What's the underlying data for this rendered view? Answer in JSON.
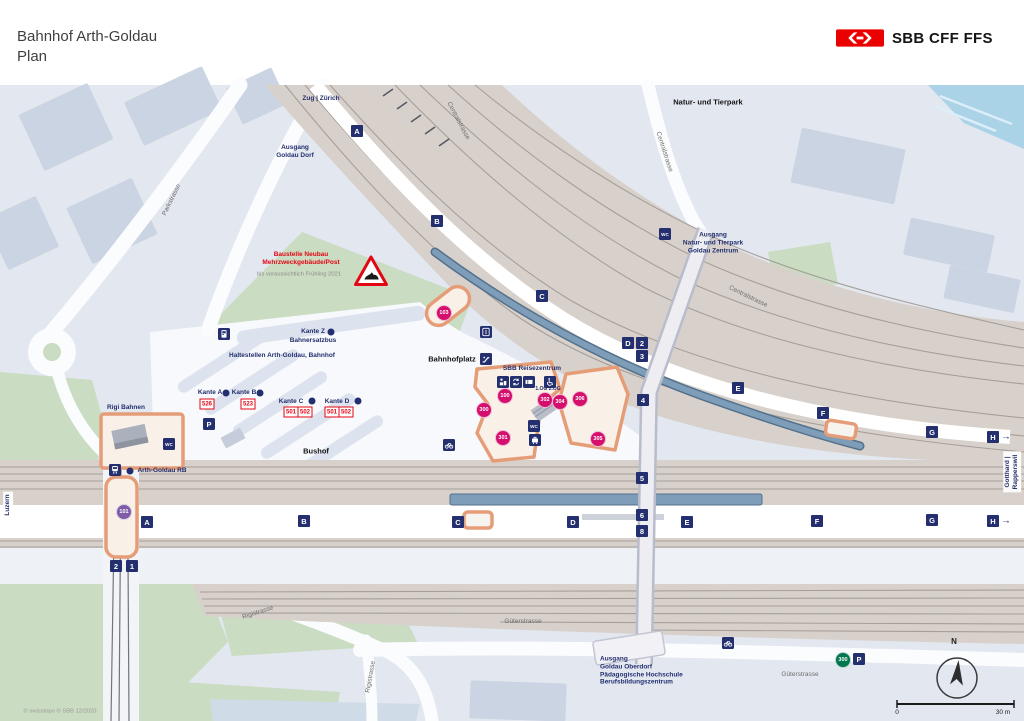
{
  "header": {
    "title_line1": "Bahnhof Arth-Goldau",
    "title_line2": "Plan",
    "logo_text": "SBB CFF FFS"
  },
  "colors": {
    "sbb_red": "#eb0000",
    "navy": "#232f6e",
    "magenta": "#d40f6e",
    "purple": "#7e5ca6",
    "green_parking": "#00774e",
    "rail_beige": "#d8d1cb",
    "canopy_blue": "#7e9db8",
    "orange_building": "#e59d78"
  },
  "map": {
    "labels": [
      {
        "n": "label-zug-zuerich",
        "t": "Zug | Zürich",
        "x": 321,
        "y": 99,
        "c": "navy"
      },
      {
        "n": "label-ausgang-goldau-dorf",
        "t": "Ausgang\nGoldau Dorf",
        "x": 295,
        "y": 152,
        "c": "navy"
      },
      {
        "n": "label-natur-und-tierpark",
        "t": "Natur- und Tierpark",
        "x": 708,
        "y": 102,
        "c": "black"
      },
      {
        "n": "label-ausgang-tierpark",
        "t": "Ausgang\nNatur- und Tierpark\nGoldau Zentrum",
        "x": 713,
        "y": 243,
        "c": "navy"
      },
      {
        "n": "label-baustelle",
        "t": "Baustelle Neubau\nMehrzweckgebäude/Post",
        "x": 301,
        "y": 259,
        "c": "red"
      },
      {
        "n": "label-baustelle-note",
        "t": "bis voraussichtlich Frühling 2021",
        "x": 299,
        "y": 275,
        "c": "gsm"
      },
      {
        "n": "label-kante-z",
        "t": "Kante Z",
        "x": 313,
        "y": 332,
        "c": "navy"
      },
      {
        "n": "label-bahnersatzbus",
        "t": "Bahnersatzbus",
        "x": 313,
        "y": 341,
        "c": "navy"
      },
      {
        "n": "label-haltestellen",
        "t": "Haltestellen Arth-Goldau, Bahnhof",
        "x": 282,
        "y": 356,
        "c": "navy"
      },
      {
        "n": "label-kante-a",
        "t": "Kante A",
        "x": 210,
        "y": 393,
        "c": "navy"
      },
      {
        "n": "label-kante-b",
        "t": "Kante B",
        "x": 244,
        "y": 393,
        "c": "navy"
      },
      {
        "n": "label-kante-c",
        "t": "Kante C",
        "x": 291,
        "y": 402,
        "c": "navy"
      },
      {
        "n": "label-kante-d",
        "t": "Kante D",
        "x": 337,
        "y": 402,
        "c": "navy"
      },
      {
        "n": "label-rigi-bahnen",
        "t": "Rigi Bahnen",
        "x": 126,
        "y": 408,
        "c": "navy"
      },
      {
        "n": "label-arth-goldau-rb",
        "t": "Arth-Goldau RB",
        "x": 162,
        "y": 471,
        "c": "navy"
      },
      {
        "n": "label-bushof",
        "t": "Bushof",
        "x": 316,
        "y": 451,
        "c": "black"
      },
      {
        "n": "label-bahnhofplatz",
        "t": "Bahnhofplatz",
        "x": 452,
        "y": 359,
        "c": "black"
      },
      {
        "n": "label-sbb-reisezentrum",
        "t": "SBB Reisezentrum",
        "x": 532,
        "y": 369,
        "c": "navy"
      },
      {
        "n": "label-og-levels",
        "t": "1.OG  2.OG",
        "x": 548,
        "y": 389,
        "c": "tiny"
      },
      {
        "n": "label-ausgang-oberdorf",
        "t": "Ausgang\nGoldau Oberdorf\nPädagogische Hochschule\nBerufsbildungszentrum",
        "x": 600,
        "y": 671,
        "c": "navy",
        "a": "left"
      },
      {
        "n": "label-parkstrasse",
        "t": "Parkstrasse",
        "x": 172,
        "y": 200,
        "c": "street",
        "r": -64
      },
      {
        "n": "label-centralstrasse-1",
        "t": "Centralstrasse",
        "x": 458,
        "y": 121,
        "c": "street",
        "r": 62
      },
      {
        "n": "label-centralstrasse-2",
        "t": "Centralstrasse",
        "x": 664,
        "y": 152,
        "c": "street",
        "r": 72
      },
      {
        "n": "label-centralstrasse-3",
        "t": "Centralstrasse",
        "x": 748,
        "y": 297,
        "c": "street",
        "r": 26
      },
      {
        "n": "label-rigistrasse-1",
        "t": "Rigistrasse",
        "x": 258,
        "y": 613,
        "c": "street",
        "r": -18
      },
      {
        "n": "label-rigistrasse-2",
        "t": "Rigistrasse",
        "x": 371,
        "y": 677,
        "c": "street",
        "r": -80
      },
      {
        "n": "label-gueterstrasse-1",
        "t": "Güterstrasse",
        "x": 523,
        "y": 622,
        "c": "street"
      },
      {
        "n": "label-gueterstrasse-2",
        "t": "Güterstrasse",
        "x": 800,
        "y": 675,
        "c": "street"
      },
      {
        "n": "label-luzern",
        "t": "Luzern",
        "x": 8,
        "y": 505,
        "c": "edge",
        "r": -90
      },
      {
        "n": "label-gotthard-rapperswil",
        "t": "Gotthard | Rapperswil",
        "x": 1012,
        "y": 472,
        "c": "edge",
        "r": -90
      },
      {
        "n": "label-copyright",
        "t": "© swisstopo   © SBB 12/2020",
        "x": 60,
        "y": 712,
        "c": "copy"
      },
      {
        "n": "label-scale-zero",
        "t": "0",
        "x": 897,
        "y": 713,
        "c": "scale"
      },
      {
        "n": "label-scale-max",
        "t": "30 m",
        "x": 1003,
        "y": 713,
        "c": "scale"
      },
      {
        "n": "label-compass-north",
        "t": "N",
        "x": 954,
        "y": 642,
        "c": "N"
      }
    ],
    "squares": [
      {
        "t": "A",
        "x": 357,
        "y": 131
      },
      {
        "t": "B",
        "x": 437,
        "y": 221
      },
      {
        "t": "C",
        "x": 542,
        "y": 296
      },
      {
        "t": "D",
        "x": 628,
        "y": 343
      },
      {
        "t": "2",
        "x": 642,
        "y": 343
      },
      {
        "t": "3",
        "x": 642,
        "y": 356
      },
      {
        "t": "4",
        "x": 643,
        "y": 400
      },
      {
        "t": "E",
        "x": 738,
        "y": 388
      },
      {
        "t": "F",
        "x": 823,
        "y": 413
      },
      {
        "t": "G",
        "x": 932,
        "y": 432
      },
      {
        "t": "H",
        "x": 993,
        "y": 437,
        "arrow": true
      },
      {
        "t": "A",
        "x": 147,
        "y": 522
      },
      {
        "t": "B",
        "x": 304,
        "y": 521
      },
      {
        "t": "C",
        "x": 458,
        "y": 522
      },
      {
        "t": "D",
        "x": 573,
        "y": 522
      },
      {
        "t": "E",
        "x": 687,
        "y": 522
      },
      {
        "t": "F",
        "x": 817,
        "y": 521
      },
      {
        "t": "G",
        "x": 932,
        "y": 520
      },
      {
        "t": "H",
        "x": 993,
        "y": 521,
        "arrow": true
      },
      {
        "t": "5",
        "x": 642,
        "y": 478
      },
      {
        "t": "6",
        "x": 642,
        "y": 515
      },
      {
        "t": "8",
        "x": 642,
        "y": 531
      },
      {
        "t": "2",
        "x": 116,
        "y": 566
      },
      {
        "t": "1",
        "x": 132,
        "y": 566
      }
    ],
    "circles": [
      {
        "t": "103",
        "x": 444,
        "y": 313,
        "col": "#d40f6e"
      },
      {
        "t": "100",
        "x": 505,
        "y": 396,
        "col": "#d40f6e"
      },
      {
        "t": "300",
        "x": 484,
        "y": 410,
        "col": "#d40f6e"
      },
      {
        "t": "301",
        "x": 503,
        "y": 438,
        "col": "#d40f6e"
      },
      {
        "t": "302",
        "x": 545,
        "y": 400,
        "col": "#d40f6e"
      },
      {
        "t": "304",
        "x": 560,
        "y": 402,
        "col": "#d40f6e"
      },
      {
        "t": "306",
        "x": 580,
        "y": 399,
        "col": "#d40f6e"
      },
      {
        "t": "305",
        "x": 598,
        "y": 439,
        "col": "#d40f6e"
      },
      {
        "t": "101",
        "x": 124,
        "y": 512,
        "col": "#7e5ca6"
      },
      {
        "t": "300",
        "x": 843,
        "y": 660,
        "col": "#00774e"
      }
    ],
    "routes": [
      {
        "t": "526",
        "x": 207,
        "y": 404
      },
      {
        "t": "523",
        "x": 248,
        "y": 404
      },
      {
        "t": "501",
        "x": 291,
        "y": 412
      },
      {
        "t": "502",
        "x": 305,
        "y": 412
      },
      {
        "t": "501",
        "x": 332,
        "y": 412
      },
      {
        "t": "502",
        "x": 346,
        "y": 412
      }
    ],
    "icons": [
      {
        "n": "wc-icon-tierpark",
        "k": "wc",
        "x": 665,
        "y": 234
      },
      {
        "n": "ticket-machine-icon-kante-z",
        "k": "machine",
        "x": 224,
        "y": 334
      },
      {
        "n": "parking-icon-bushof",
        "k": "p",
        "x": 209,
        "y": 424
      },
      {
        "n": "wc-icon-rigi",
        "k": "wc",
        "x": 169,
        "y": 444
      },
      {
        "n": "train-icon-arth-goldau-rb",
        "k": "train",
        "x": 115,
        "y": 470
      },
      {
        "n": "bus-stop-dot-arth-goldau-rb",
        "k": "dot",
        "x": 130,
        "y": 471
      },
      {
        "n": "bus-stop-dot-kante-z",
        "k": "dot",
        "x": 331,
        "y": 332
      },
      {
        "n": "bus-stop-dot-kante-a",
        "k": "dot",
        "x": 226,
        "y": 393
      },
      {
        "n": "bus-stop-dot-kante-b",
        "k": "dot",
        "x": 260,
        "y": 393
      },
      {
        "n": "bus-stop-dot-kante-c",
        "k": "dot",
        "x": 312,
        "y": 401
      },
      {
        "n": "bus-stop-dot-kante-d",
        "k": "dot",
        "x": 358,
        "y": 401
      },
      {
        "n": "lift-icon-platform",
        "k": "lift",
        "x": 486,
        "y": 332
      },
      {
        "n": "escalator-icon-platform",
        "k": "esc",
        "x": 486,
        "y": 359
      },
      {
        "n": "counter-icon-reisezentrum",
        "k": "counter",
        "x": 503,
        "y": 382
      },
      {
        "n": "exchange-icon-reisezentrum",
        "k": "exchange",
        "x": 516,
        "y": 382
      },
      {
        "n": "ticket-icon-reisezentrum",
        "k": "ticket",
        "x": 529,
        "y": 382
      },
      {
        "n": "wheelchair-icon-reisezentrum",
        "k": "wheelchair",
        "x": 550,
        "y": 382
      },
      {
        "n": "wc-icon-reisezentrum",
        "k": "wc",
        "x": 534,
        "y": 426
      },
      {
        "n": "luggage-icon-reisezentrum",
        "k": "luggage",
        "x": 535,
        "y": 440
      },
      {
        "n": "bicycle-icon-bahnhofplatz",
        "k": "velo",
        "x": 449,
        "y": 445
      },
      {
        "n": "bicycle-icon-gueterstrasse",
        "k": "velo",
        "x": 728,
        "y": 643
      },
      {
        "n": "parking-icon-gueterstrasse",
        "k": "p",
        "x": 859,
        "y": 659
      },
      {
        "n": "construction-icon",
        "k": "construction",
        "x": 371,
        "y": 271
      }
    ]
  }
}
